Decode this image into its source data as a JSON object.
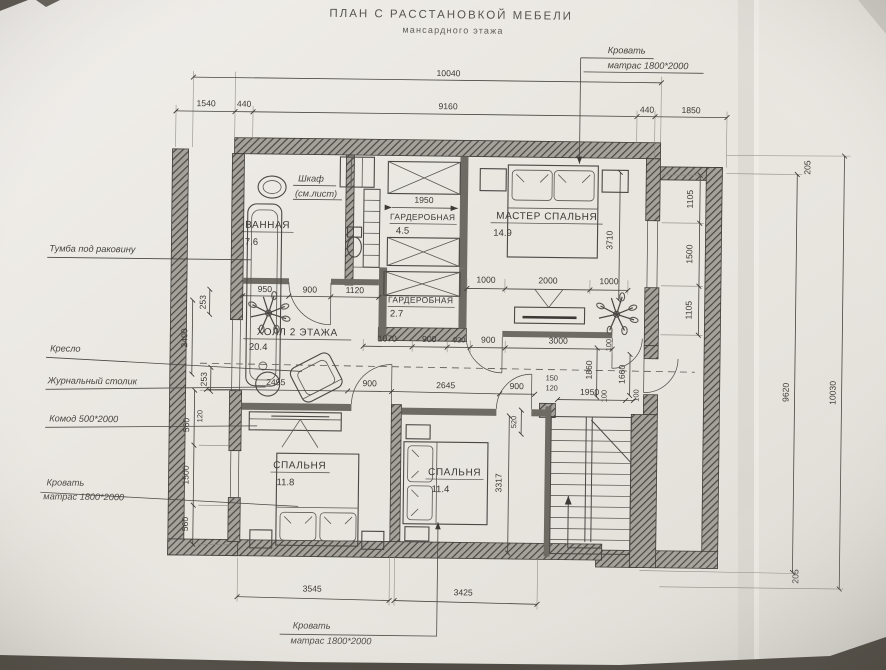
{
  "title": {
    "main": "ПЛАН С РАССТАНОВКОЙ МЕБЕЛИ",
    "sub": "мансардного этажа"
  },
  "rooms": {
    "bathroom": {
      "name": "ВАННАЯ",
      "area": "7.6"
    },
    "wardrobe_top": {
      "name": "ГАРДЕРОБНАЯ",
      "area": "4.5"
    },
    "master_bedroom": {
      "name": "МАСТЕР СПАЛЬНЯ",
      "area": "14.9"
    },
    "wardrobe_small": {
      "name": "ГАРДЕРОБНАЯ",
      "area": "2.7"
    },
    "hall": {
      "name": "ХОЛЛ 2 ЭТАЖА",
      "area": "20.4"
    },
    "bedroom_left": {
      "name": "СПАЛЬНЯ",
      "area": "11.8"
    },
    "bedroom_right": {
      "name": "СПАЛЬНЯ",
      "area": "11.4"
    }
  },
  "callouts": {
    "wardrobe_note1": "Шкаф",
    "wardrobe_note2": "(см.лист)",
    "bed_master1": "Кровать",
    "bed_master2": "матрас 1800*2000",
    "sink_cabinet": "Тумба под раковину",
    "armchair": "Кресло",
    "coffee_table": "Журнальный столик",
    "commode": "Комод 500*2000",
    "bed_left1": "Кровать",
    "bed_left2": "матрас 1800*2000",
    "bed_bottom1": "Кровать",
    "bed_bottom2": "матрас 1800*2000"
  },
  "dims": {
    "top_overall": "10040",
    "top_1540": "1540",
    "top_440l": "440",
    "top_9160": "9160",
    "top_440r": "440",
    "top_1850": "1850",
    "right_205t": "205",
    "right_1105a": "1105",
    "right_1500": "1500",
    "right_1105b": "1105",
    "right_9620": "9620",
    "right_10030": "10030",
    "right_205b": "205",
    "master_3710": "3710",
    "bath_950": "950",
    "bath_900": "900",
    "bath_1120": "1120",
    "ward_1950": "1950",
    "master_1000l": "1000",
    "master_2000": "2000",
    "master_1000r": "1000",
    "mid_1070": "1070",
    "mid_900a": "900",
    "mid_920": "920",
    "mid_900b": "900",
    "mid_3000": "3000",
    "mid_100": "100",
    "mid_1860": "1860",
    "mid_1660": "1660",
    "mid_100b": "100",
    "hall_2495": "2495",
    "hall_900": "900",
    "hall_2645": "2645",
    "hall_900b": "900",
    "stair_150": "150",
    "stair_120": "120",
    "stair_1950": "1950",
    "stair_100": "100",
    "bed2_520": "520",
    "bed2_3317": "3317",
    "left_253a": "253",
    "left_2400": "2400",
    "left_253b": "253",
    "left_120": "120",
    "left_560a": "560",
    "left_1500": "1500",
    "left_560b": "560",
    "bottom_3545": "3545",
    "bottom_3425": "3425"
  }
}
